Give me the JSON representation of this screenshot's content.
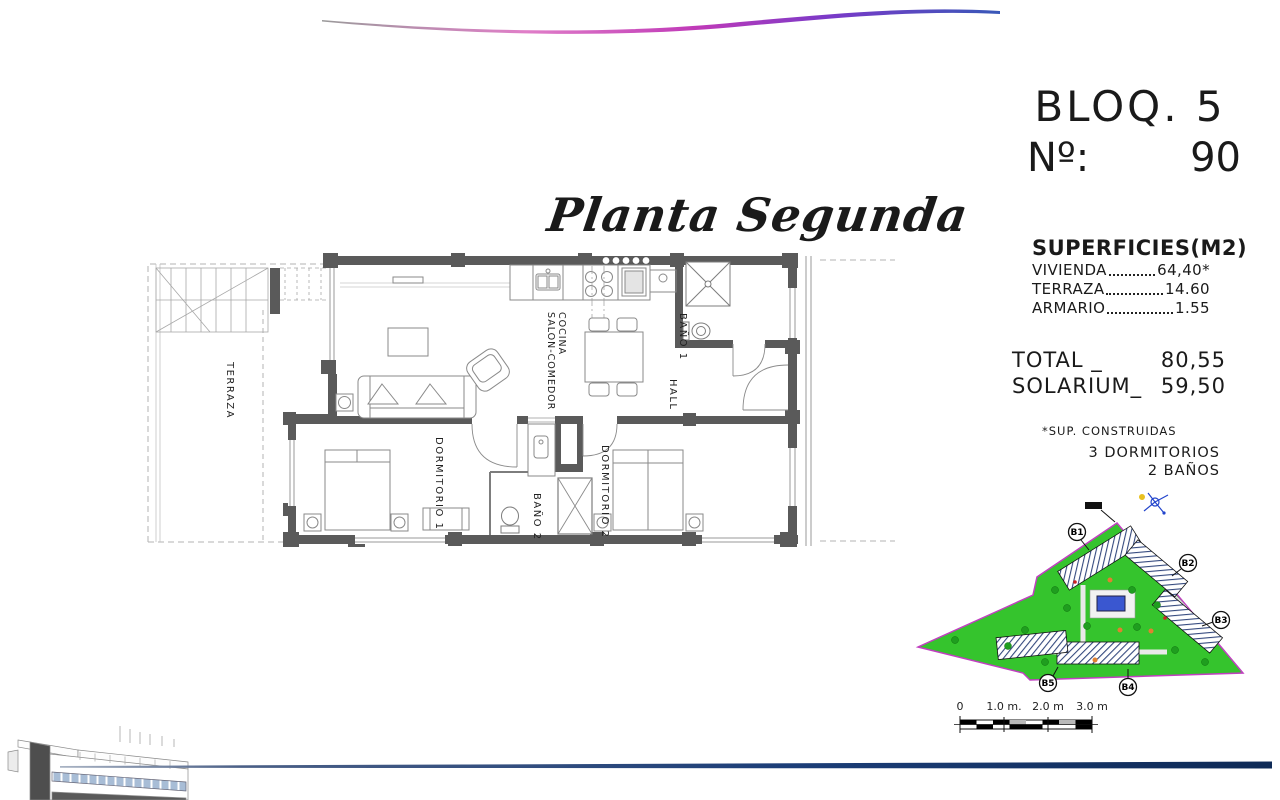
{
  "header": {
    "block": "BLOQ. 5",
    "number_label": "Nº:",
    "number_value": "90"
  },
  "plan_title": "Planta Segunda",
  "superficies": {
    "heading": "SUPERFICIES(M2)",
    "rows": [
      {
        "label": "VIVIENDA",
        "value": "64,40*"
      },
      {
        "label": "TERRAZA",
        "value": "14.60"
      },
      {
        "label": "ARMARIO",
        "value": "1.55"
      }
    ],
    "total_label": "TOTAL _",
    "total_value": "80,55",
    "solarium_label": "SOLARIUM_",
    "solarium_value": "59,50",
    "footnote": "*SUP. CONSTRUIDAS"
  },
  "program": {
    "bedrooms": "3 DORMITORIOS",
    "bathrooms": "2 BAÑOS"
  },
  "floorplan": {
    "rooms": {
      "terraza": "TERRAZA",
      "salon_line1": "SALON-COMEDOR",
      "salon_line2": "COCINA",
      "bano1": "BAÑO 1",
      "hall": "HALL",
      "dormitorio1": "DORMITORIO 1",
      "bano2": "BAÑO 2",
      "dormitorio2": "DORMITORIO 2"
    }
  },
  "siteplan": {
    "block_labels": [
      "B1",
      "B2",
      "B3",
      "B4",
      "B5"
    ]
  },
  "scalebar": {
    "ticks": [
      "0",
      "1.0 m.",
      "2.0 m",
      "3.0 m"
    ]
  },
  "colors": {
    "wall_gray": "#5a5a5a",
    "site_green": "#35c42d",
    "site_border": "#c040c0",
    "pool_blue": "#3a57d0",
    "bottom_rule_blue": "#1c3e78",
    "wave_magenta": "#c03ab8"
  }
}
